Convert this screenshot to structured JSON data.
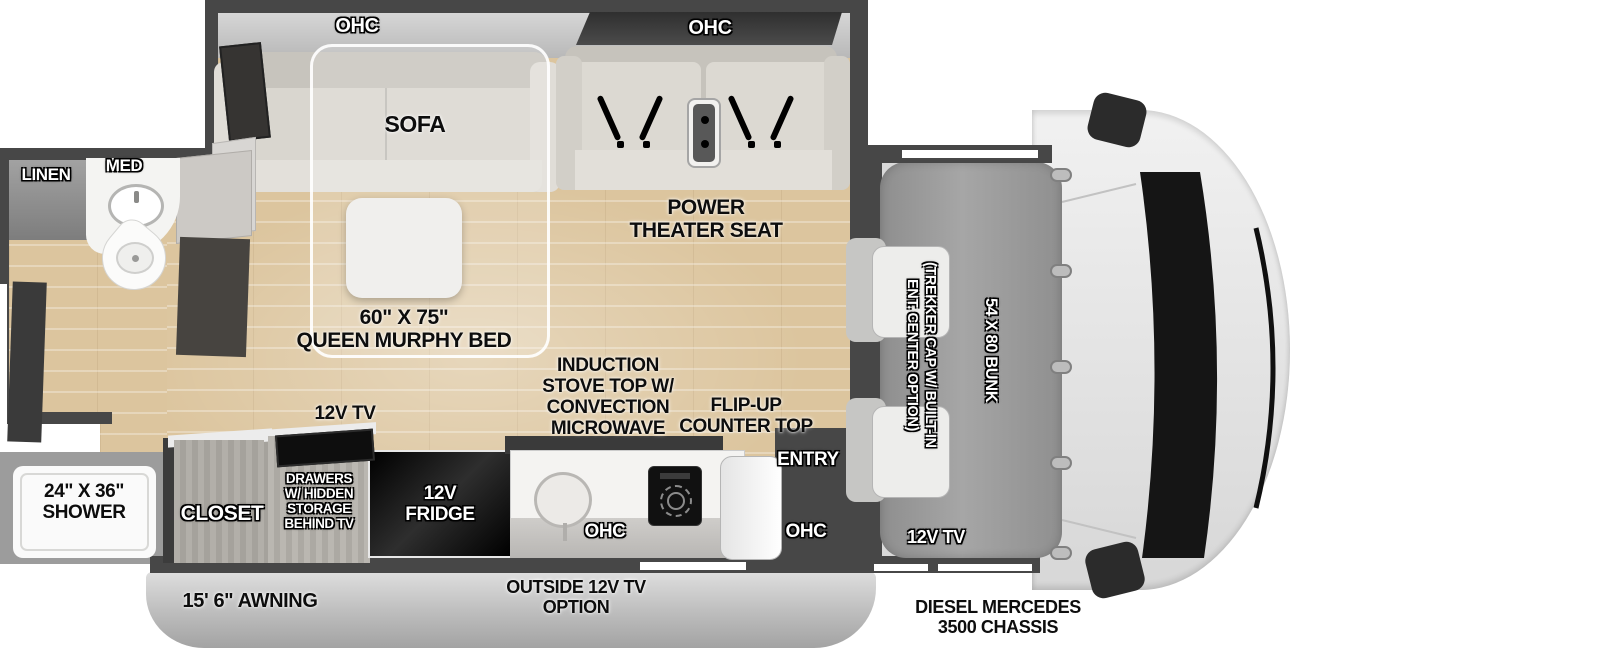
{
  "colors": {
    "wood": "#dcc59e",
    "wall": "#474747",
    "cabinet_gray": "#aba8a2",
    "bunk_gray": "#9a9a9a",
    "awning_gray": "#c2c2c2",
    "appliance_black": "#111111"
  },
  "living": {
    "ohc_left": "OHC",
    "ohc_right": "OHC",
    "sofa": "SOFA",
    "murphy_bed_size": "60\" X 75\"",
    "murphy_bed_name": "QUEEN MURPHY BED",
    "theater_seat": "POWER\nTHEATER SEAT",
    "tv": "12V TV"
  },
  "bathroom": {
    "linen": "LINEN",
    "med": "MED",
    "shower": "24\" X 36\"\nSHOWER"
  },
  "kitchen": {
    "induction": "INDUCTION\nSTOVE TOP W/\nCONVECTION\nMICROWAVE",
    "flip_up": "FLIP-UP\nCOUNTER TOP",
    "closet": "CLOSET",
    "drawers": "DRAWERS\nW/ HIDDEN\nSTORAGE\nBEHIND TV",
    "fridge": "12V\nFRIDGE",
    "ohc_left": "OHC",
    "ohc_right": "OHC",
    "entry": "ENTRY"
  },
  "cab": {
    "bunk": "54 X 80 BUNK",
    "cap_option": "(TREKKER CAP W/ BUILT-IN\nENT. CENTER OPTION)",
    "tv": "12V TV",
    "chassis": "DIESEL MERCEDES\n3500 CHASSIS"
  },
  "exterior": {
    "awning": "15' 6\" AWNING",
    "outside_tv": "OUTSIDE 12V TV\nOPTION"
  }
}
